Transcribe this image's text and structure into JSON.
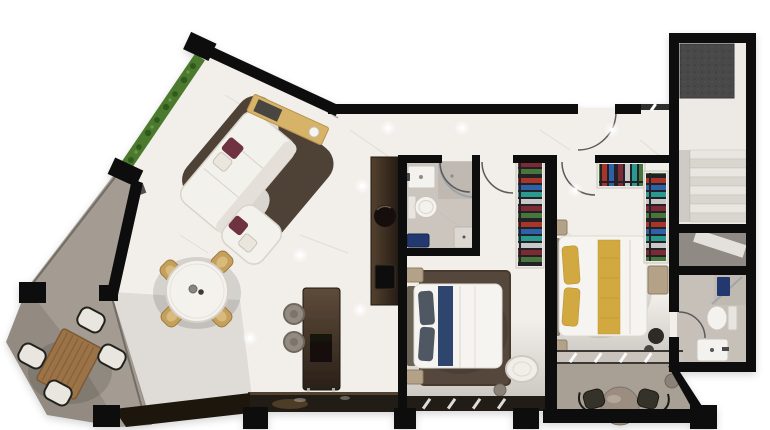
{
  "scene": {
    "description": "photorealistic top-down 3D render of a two-bedroom apartment floor plan on a white background, black cut walls, white marble floors, gray concrete balconies",
    "rooms": [
      {
        "name": "terrace-balcony",
        "furniture": [
          "boxwood-hedge-planter",
          "wood-slat-outdoor-table",
          "outdoor-chairs-x4"
        ]
      },
      {
        "name": "living-room",
        "furniture": [
          "l-shaped-white-sofa",
          "burgundy-accent-cushions",
          "dark-area-rug",
          "yellow-console-sideboard",
          "decor-vase"
        ]
      },
      {
        "name": "dining-area",
        "furniture": [
          "round-white-dining-table",
          "gold-upholstered-chairs-x4",
          "tabletop-decor"
        ]
      },
      {
        "name": "kitchen",
        "furniture": [
          "dark-tall-cabinet-column",
          "round-basin",
          "cooktop",
          "island-counter",
          "bar-stools-x2",
          "window-counter"
        ]
      },
      {
        "name": "main-bathroom",
        "furniture": [
          "washbasin",
          "toilet",
          "curved-glass-shower",
          "navy-bench",
          "storage-box"
        ]
      },
      {
        "name": "bedroom-2",
        "furniture": [
          "double-bed-white-duvet",
          "gray-pillows",
          "navy-throw",
          "brown-area-rug",
          "nightstands-x2",
          "wardrobe-with-hanging-clothes",
          "white-lounge-chair",
          "side-table"
        ]
      },
      {
        "name": "hallway",
        "furniture": [
          "entry-door-swing",
          "ceiling-spotlights"
        ]
      },
      {
        "name": "master-bedroom",
        "furniture": [
          "double-bed-yellow-runner",
          "yellow-pillows",
          "nightstands-x2",
          "wardrobes-with-hanging-clothes-x2",
          "dresser",
          "dark-pouf"
        ]
      },
      {
        "name": "ensuite-bathroom",
        "furniture": [
          "shower",
          "toilet",
          "washbasin",
          "door-swing"
        ]
      },
      {
        "name": "master-balcony",
        "furniture": [
          "round-bistro-table",
          "dark-chairs-x2",
          "side-table"
        ]
      },
      {
        "name": "staircase-hall",
        "furniture": [
          "staircase-steps",
          "dark-feature-wall",
          "understair-storage"
        ]
      }
    ]
  },
  "colors": {
    "background": "#ffffff",
    "wall": "#101010",
    "floor": "#f2efea",
    "bath_floor": "#cbc5be",
    "shower_floor": "#bfb9b2",
    "ensuite_floor": "#c6c0b9",
    "balcony_floor": "#a49c92",
    "master_balcony_floor": "#a89f95",
    "stair_floor": "#edeae5",
    "step_light": "#e9e6e1",
    "step_dark": "#d9d5cf",
    "feature_wall": "#4a4948",
    "understair": "#8f8a84",
    "hedge": "#4b7a2e",
    "hedge_dark": "#2f5a1c",
    "wood": "#9c7347",
    "wood_dark": "#7d5a36",
    "sofa": "#f3f1ec",
    "sofa_shade": "#d8d3cb",
    "rug_living": "#463a2d",
    "cushion": "#6e3140",
    "console": "#d7b269",
    "vase": "#f7f5f1",
    "table_white": "#f4f2ed",
    "chair_gold": "#c4a05c",
    "island_dark": "#241b14",
    "counter": "#241d17",
    "stool": "#938b81",
    "bed_white": "#f6f4f0",
    "headboard": "#6b6257",
    "pillow_gray": "#4f5862",
    "throw_navy": "#223a66",
    "rug_bedroom": "#54473a",
    "nightstand": "#b3a188",
    "runner_yellow": "#d2a93f",
    "fixture_white": "#f4f2ee",
    "accent_navy": "#22386e",
    "glass": "#97a0a6",
    "pouf_dark": "#2e2a26",
    "outdoor_table": "#9b8d80",
    "window_sill": "#1c1611",
    "clothes_bg": "#232326",
    "clothes_red": "#a8352a",
    "clothes_blue": "#2e62a8",
    "clothes_teal": "#2a9a90",
    "clothes_green": "#46743a",
    "clothes_maroon": "#7c2b35",
    "clothes_gray": "#c8c8c8"
  }
}
